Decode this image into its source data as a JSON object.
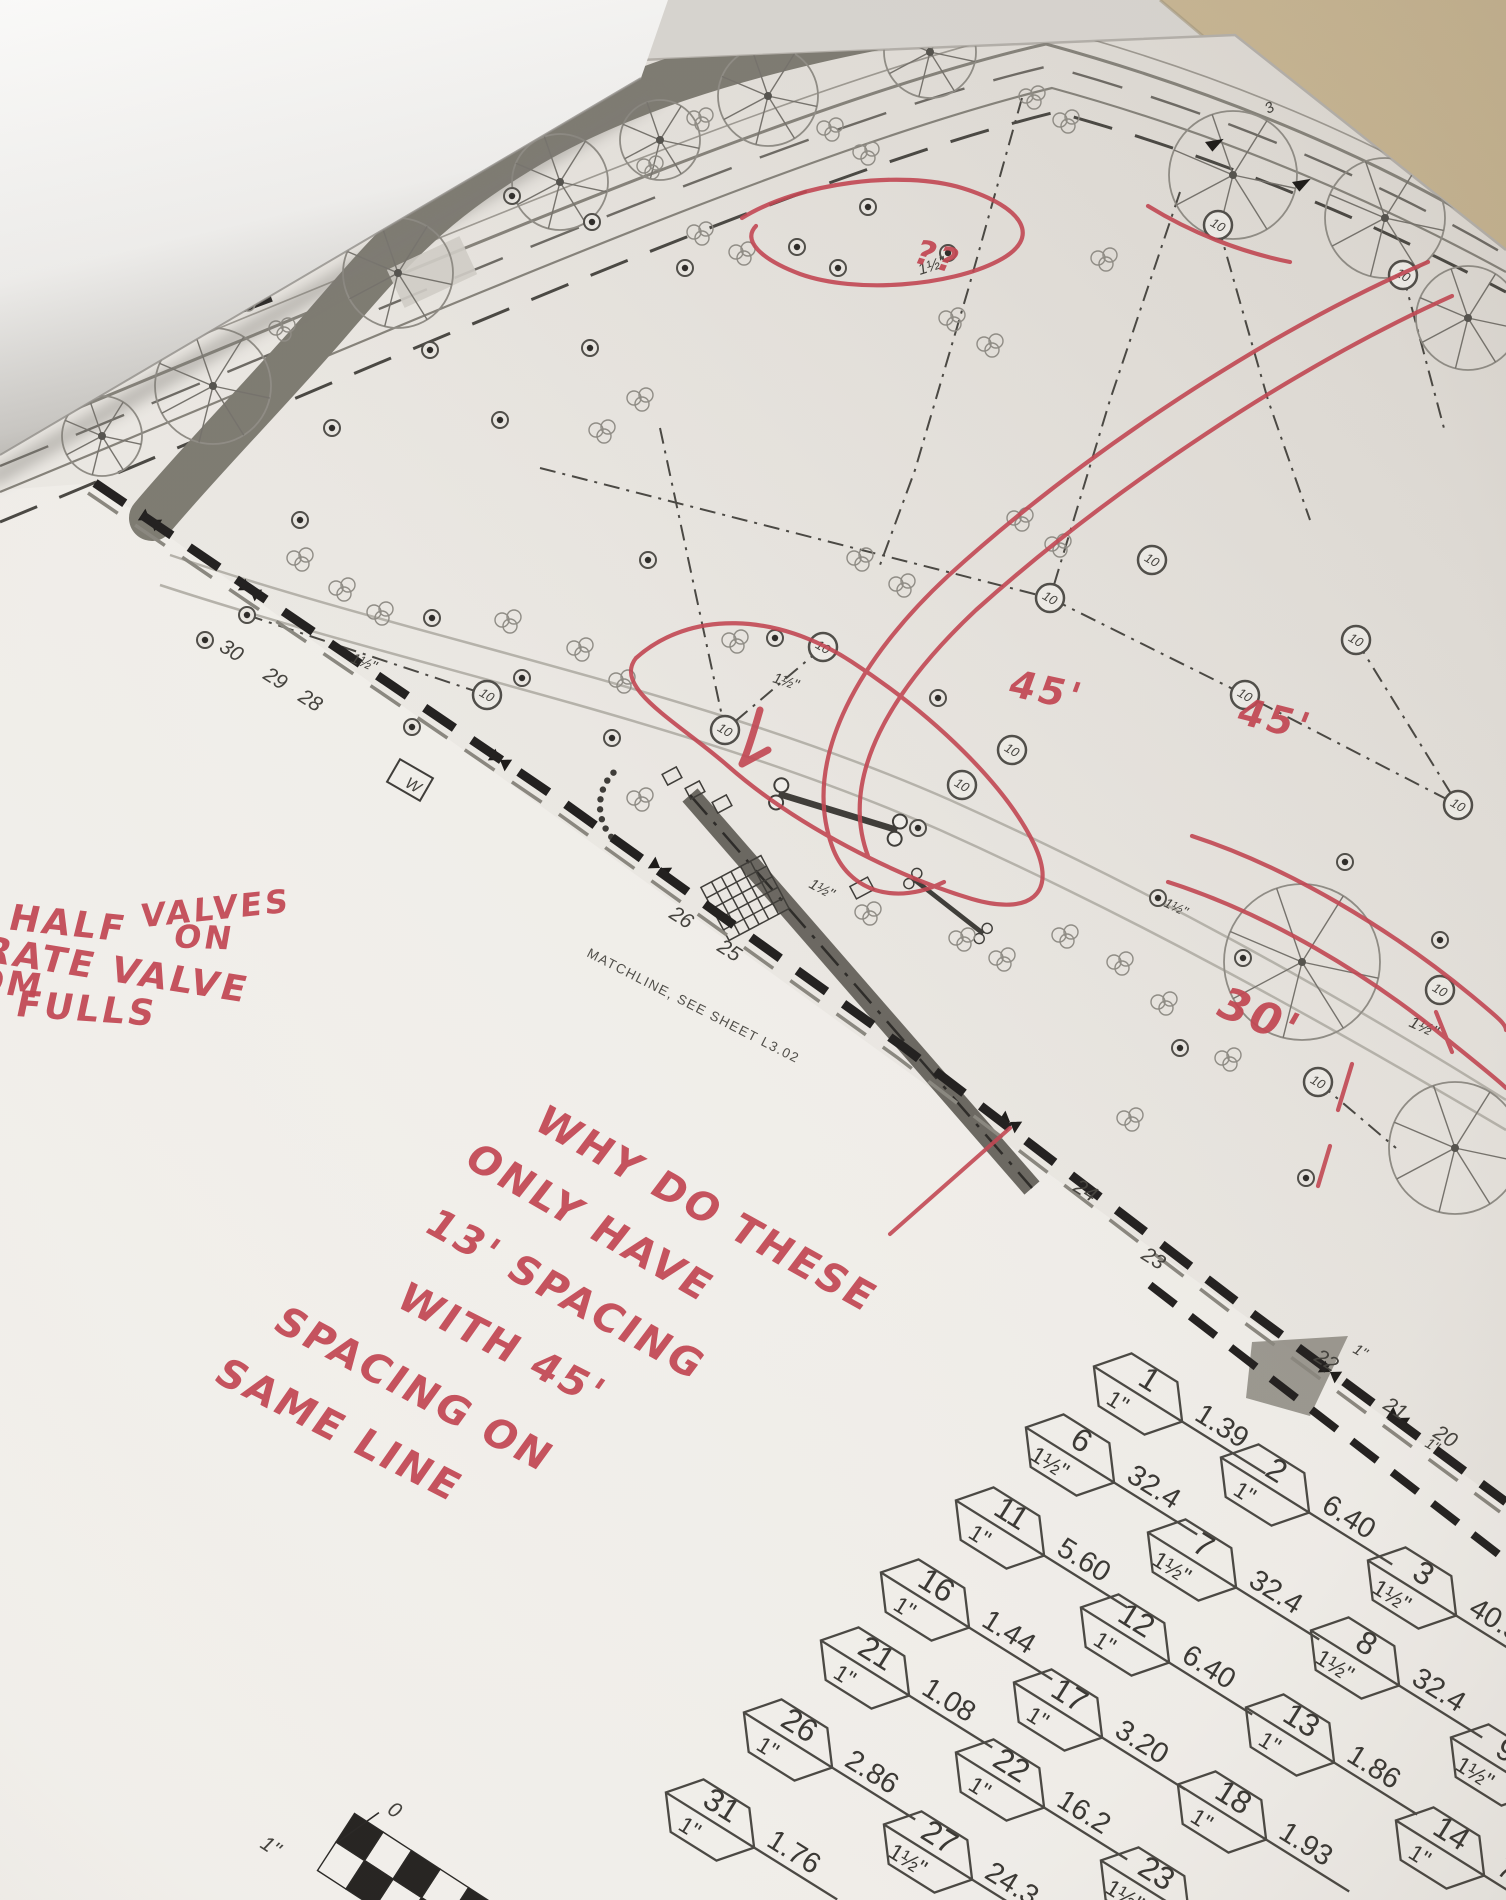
{
  "scene": {
    "description": "Photograph of a printed landscape irrigation plan sheet lying on a table, top-left corner of sheet folded over, with red marker review notes",
    "street_label": "GRAND CADENCE DRIVE",
    "matchline_label": "MATCHLINE, SEE SHEET L3.02",
    "head_radius_label": "10",
    "red_ink_color": "#c24753",
    "red_annotations": {
      "note_left": {
        "lines": [
          {
            "text": "PUT  HALF",
            "x": 33,
            "y": 932,
            "rot": 6,
            "size": 36
          },
          {
            "text": "VALVES",
            "x": 268,
            "y": 914,
            "rot": -6,
            "size": 32
          },
          {
            "text": "ON",
            "x": 306,
            "y": 952,
            "rot": 2,
            "size": 32
          },
          {
            "text": "SEPARATE  VALVE",
            "x": 2,
            "y": 964,
            "rot": 9,
            "size": 36
          },
          {
            "text": "FROM",
            "x": 57,
            "y": 1000,
            "rot": 6,
            "size": 34
          },
          {
            "text": "FULLS",
            "x": 158,
            "y": 1026,
            "rot": 4,
            "size": 36
          }
        ]
      },
      "note_center": {
        "lines": [
          {
            "text": "WHY DO THESE",
            "x": 680,
            "y": 1210,
            "rot": 29,
            "size": 40
          },
          {
            "text": "ONLY  HAVE",
            "x": 614,
            "y": 1252,
            "rot": 30,
            "size": 40
          },
          {
            "text": "13'  SPACING",
            "x": 584,
            "y": 1320,
            "rot": 29,
            "size": 40
          },
          {
            "text": "WITH  45'",
            "x": 568,
            "y": 1394,
            "rot": 27,
            "size": 40
          },
          {
            "text": "SPACING  ON",
            "x": 447,
            "y": 1422,
            "rot": 28,
            "size": 40
          },
          {
            "text": "SAME  LINE",
            "x": 396,
            "y": 1474,
            "rot": 27,
            "size": 40
          }
        ]
      },
      "dim_labels": [
        {
          "text": "??",
          "x": 948,
          "y": 272,
          "rot": 16,
          "size": 34
        },
        {
          "text": "45'",
          "x": 1104,
          "y": 716,
          "rot": 12,
          "size": 38
        },
        {
          "text": "45'",
          "x": 1336,
          "y": 748,
          "rot": 14,
          "size": 38
        },
        {
          "text": "30'",
          "x": 1352,
          "y": 1070,
          "rot": 22,
          "size": 44
        }
      ]
    },
    "valve_callouts": {
      "items": [
        {
          "station": "1",
          "size": "1\"",
          "value": "1.39",
          "x": 1138,
          "y": 1394
        },
        {
          "station": "2",
          "size": "1\"",
          "value": "6.40",
          "x": 1265,
          "y": 1485
        },
        {
          "station": "3",
          "size": "1½\"",
          "value": "40.5",
          "x": 1412,
          "y": 1588
        },
        {
          "station": "6",
          "size": "1½\"",
          "value": "32.4",
          "x": 1070,
          "y": 1455
        },
        {
          "station": "7",
          "size": "1½\"",
          "value": "32.4",
          "x": 1192,
          "y": 1560
        },
        {
          "station": "8",
          "size": "1½\"",
          "value": "32.4",
          "x": 1355,
          "y": 1658
        },
        {
          "station": "9",
          "size": "1½\"",
          "value": "",
          "x": 1495,
          "y": 1765
        },
        {
          "station": "11",
          "size": "1\"",
          "value": "5.60",
          "x": 1000,
          "y": 1528
        },
        {
          "station": "12",
          "size": "1\"",
          "value": "6.40",
          "x": 1125,
          "y": 1635
        },
        {
          "station": "13",
          "size": "1\"",
          "value": "1.86",
          "x": 1290,
          "y": 1735
        },
        {
          "station": "14",
          "size": "1\"",
          "value": "7.0",
          "x": 1440,
          "y": 1848
        },
        {
          "station": "16",
          "size": "1\"",
          "value": "1.44",
          "x": 925,
          "y": 1600
        },
        {
          "station": "17",
          "size": "1\"",
          "value": "3.20",
          "x": 1058,
          "y": 1710
        },
        {
          "station": "18",
          "size": "1\"",
          "value": "1.93",
          "x": 1222,
          "y": 1812
        },
        {
          "station": "21",
          "size": "1\"",
          "value": "1.08",
          "x": 865,
          "y": 1668
        },
        {
          "station": "22",
          "size": "1\"",
          "value": "16.2",
          "x": 1000,
          "y": 1780
        },
        {
          "station": "23",
          "size": "1½\"",
          "value": "",
          "x": 1145,
          "y": 1888
        },
        {
          "station": "26",
          "size": "1\"",
          "value": "2.86",
          "x": 788,
          "y": 1740
        },
        {
          "station": "27",
          "size": "1½\"",
          "value": "24.3",
          "x": 928,
          "y": 1852
        },
        {
          "station": "31",
          "size": "1\"",
          "value": "1.76",
          "x": 710,
          "y": 1820
        }
      ]
    },
    "matchline_stations": [
      {
        "text": "30",
        "x": 218,
        "y": 650
      },
      {
        "text": "29",
        "x": 262,
        "y": 678
      },
      {
        "text": "28",
        "x": 297,
        "y": 700
      },
      {
        "text": "26",
        "x": 668,
        "y": 917
      },
      {
        "text": "25",
        "x": 716,
        "y": 950
      },
      {
        "text": "24",
        "x": 1072,
        "y": 1190
      },
      {
        "text": "23",
        "x": 1140,
        "y": 1258
      },
      {
        "text": "22",
        "x": 1313,
        "y": 1360
      },
      {
        "text": "21",
        "x": 1382,
        "y": 1408
      },
      {
        "text": "20",
        "x": 1432,
        "y": 1436
      }
    ],
    "plan_labels": [
      {
        "text": "1½\"",
        "x": 920,
        "y": 275,
        "rot": -18,
        "size": 16
      },
      {
        "text": "1½\"",
        "x": 350,
        "y": 662,
        "rot": 22,
        "size": 15
      },
      {
        "text": "1½\"",
        "x": 772,
        "y": 682,
        "rot": 18,
        "size": 15
      },
      {
        "text": "1½\"",
        "x": 808,
        "y": 887,
        "rot": 28,
        "size": 15
      },
      {
        "text": "1½\"",
        "x": 1408,
        "y": 1026,
        "rot": 24,
        "size": 17
      },
      {
        "text": "1½\"",
        "x": 1163,
        "y": 906,
        "rot": 26,
        "size": 14
      },
      {
        "text": "1\"",
        "x": 1352,
        "y": 1352,
        "rot": 30,
        "size": 15
      },
      {
        "text": "1\"",
        "x": 1424,
        "y": 1446,
        "rot": 30,
        "size": 15
      },
      {
        "text": "3",
        "x": 1268,
        "y": 114,
        "rot": -28,
        "size": 15
      },
      {
        "text": "4",
        "x": 1406,
        "y": 168,
        "rot": -28,
        "size": 15
      },
      {
        "text": "W",
        "x": 404,
        "y": 786,
        "rot": 30,
        "size": 16
      }
    ],
    "scale_bar": {
      "zero_label": "0",
      "size_label": "1\""
    }
  }
}
